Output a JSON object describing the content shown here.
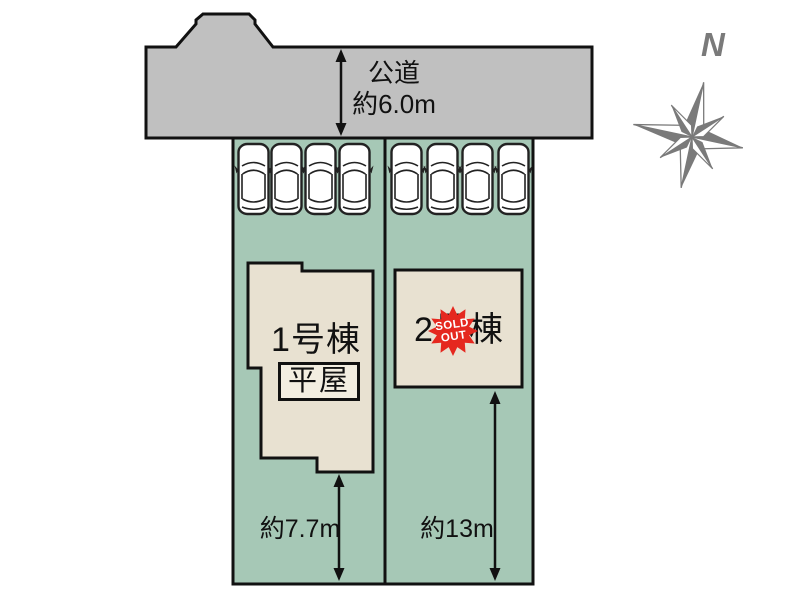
{
  "colors": {
    "road_fill": "#c0c0c0",
    "lot_fill": "#a6c8b6",
    "building_fill": "#e8e1d1",
    "hiraya_box_fill": "#f3eee1",
    "outline": "#111111",
    "compass_gray": "#7a7a7a",
    "badge_red": "#e5281f",
    "badge_text": "#ffffff"
  },
  "compass": {
    "label": "N"
  },
  "road": {
    "name_label": "公道",
    "width_label": "約6.0m"
  },
  "lots": [
    {
      "building_label": "1号棟",
      "building_type_label": "平屋",
      "depth_label": "約7.7m",
      "parked_car_count": 4
    },
    {
      "building_label": "2号棟",
      "depth_label": "約13m",
      "parked_car_count": 4
    }
  ],
  "sold_out_badge": {
    "line1": "SOLD",
    "line2": "OUT"
  }
}
